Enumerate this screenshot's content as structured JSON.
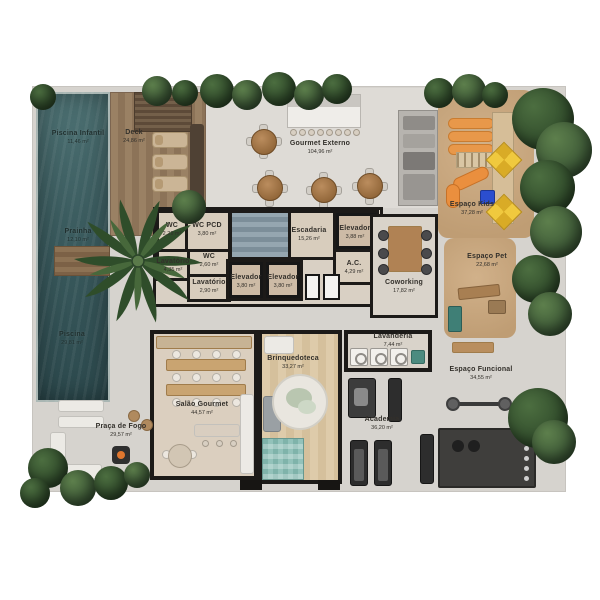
{
  "plan_title": "Pavimento de Lazer - Planta Humanizada",
  "rooms": [
    {
      "name": "Piscina Infantil",
      "area": "11,46 m²"
    },
    {
      "name": "Deck",
      "area": "24,86 m²"
    },
    {
      "name": "Gourmet Externo",
      "area": "104,96 m²"
    },
    {
      "name": "Espaço Kids",
      "area": "37,28 m²"
    },
    {
      "name": "Prainha",
      "area": "12,10 m²"
    },
    {
      "name": "WC",
      "area": "2,29 m²"
    },
    {
      "name": "WC PCD",
      "area": "3,80 m²"
    },
    {
      "name": "Escadaria",
      "area": "15,26 m²"
    },
    {
      "name": "Elevador",
      "area": "3,88 m²"
    },
    {
      "name": "Lavatório",
      "area": "4,35 m²"
    },
    {
      "name": "WC",
      "area": "2,60 m²"
    },
    {
      "name": "Lavatório",
      "area": "2,90 m²"
    },
    {
      "name": "Elevador",
      "area": "3,80 m²"
    },
    {
      "name": "Elevador",
      "area": "3,80 m²"
    },
    {
      "name": "A.C.",
      "area": "4,29 m²"
    },
    {
      "name": "Coworking",
      "area": "17,82 m²"
    },
    {
      "name": "Espaço Pet",
      "area": "22,68 m²"
    },
    {
      "name": "Piscina",
      "area": "29,81 m²"
    },
    {
      "name": "Salão Gourmet",
      "area": "44,57 m²"
    },
    {
      "name": "Brinquedoteca",
      "area": "33,27 m²"
    },
    {
      "name": "Lavanderia",
      "area": "7,44 m²"
    },
    {
      "name": "Espaço Funcional",
      "area": "34,55 m²"
    },
    {
      "name": "Academia",
      "area": "36,20 m²"
    },
    {
      "name": "Praça de Fogo",
      "area": "29,57 m²"
    }
  ],
  "colors": {
    "pool_water": "#3c5d60",
    "deck_wood": "#947b5e",
    "paving": "#d6d3ce",
    "sand": "#c6a57e",
    "wall": "#1c1a18",
    "play_yellow": "#f0c93e",
    "play_orange": "#e8984a",
    "vegetation": "#32512e",
    "interior_floor": "#dbcfbf",
    "stairs": "#869aa5"
  }
}
